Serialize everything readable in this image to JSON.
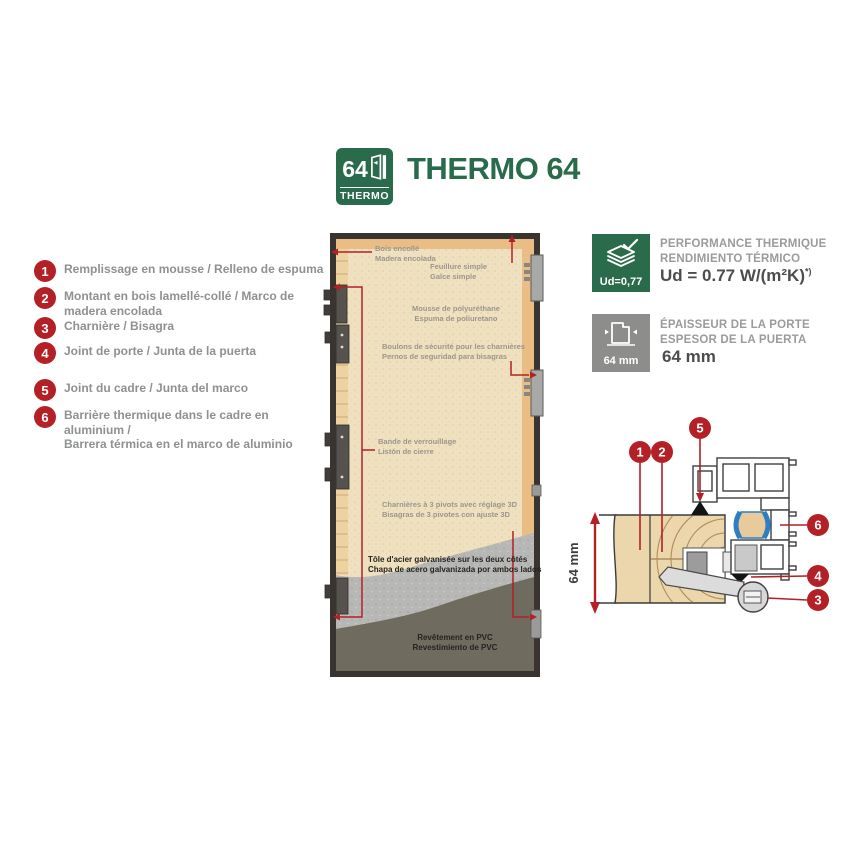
{
  "header": {
    "logo_number": "64",
    "logo_label": "THERMO",
    "title": "THERMO 64"
  },
  "legend": {
    "items": [
      {
        "num": "1",
        "text": "Remplissage en mousse / Relleno de espuma"
      },
      {
        "num": "2",
        "text": "Montant en bois lamellé-collé / Marco de madera encolada"
      },
      {
        "num": "3",
        "text": "Charnière / Bisagra"
      },
      {
        "num": "4",
        "text": "Joint de porte / Junta de la puerta"
      },
      {
        "num": "5",
        "text": "Joint du cadre / Junta del marco"
      },
      {
        "num": "6",
        "line1": "Barrière thermique dans le cadre en aluminium /",
        "line2": "Barrera térmica en el marco de aluminio"
      }
    ]
  },
  "door_diagram": {
    "labels": {
      "glued_wood": [
        "Bois encollé",
        "Madera encolada"
      ],
      "rebate": [
        "Feuillure simple",
        "Galce simple"
      ],
      "foam": [
        "Mousse de polyuréthane",
        "Espuma de poliuretano"
      ],
      "security_bolts": [
        "Boulons de sécurité pour les charnières",
        "Pernos de seguridad para bisagras"
      ],
      "locking_strip": [
        "Bande de verrouillage",
        "Listón de cierre"
      ],
      "hinges": [
        "Charnières à 3 pivots avec réglage 3D",
        "Bisagras de 3 pivotes con ajuste 3D"
      ],
      "steel_sheet": [
        "Tôle d'acier galvanisée sur les deux côtés",
        "Chapa de acero galvanizada por ambos lados"
      ],
      "pvc": [
        "Revêtement en PVC",
        "Revestimiento de PVC"
      ]
    }
  },
  "specs": {
    "thermal": {
      "icon": "layers-check-icon",
      "badge": "Ud=0,77",
      "title_fr": "PERFORMANCE THERMIQUE",
      "title_es": "RENDIMIENTO TÉRMICO",
      "value": "Ud = 0.77 W/(m²K)",
      "note": "*)"
    },
    "thickness": {
      "icon": "door-thickness-icon",
      "badge": "64 mm",
      "title_fr": "ÉPAISSEUR DE LA PORTE",
      "title_es": "ESPESOR DE LA PUERTA",
      "value": "64 mm"
    }
  },
  "cross_section": {
    "dimension": "64 mm",
    "callouts": {
      "c1": "1",
      "c2": "2",
      "c3": "3",
      "c4": "4",
      "c5": "5",
      "c6": "6"
    }
  },
  "colors": {
    "brand_green": "#2a6b4c",
    "accent_red": "#b32026",
    "thermal_blue": "#2e7fc1",
    "foam_beige": "#eedfbd",
    "wood_tan": "#edd3a0",
    "steel_gray": "#b7b7b5",
    "pvc_gray": "#6f6b5e"
  }
}
